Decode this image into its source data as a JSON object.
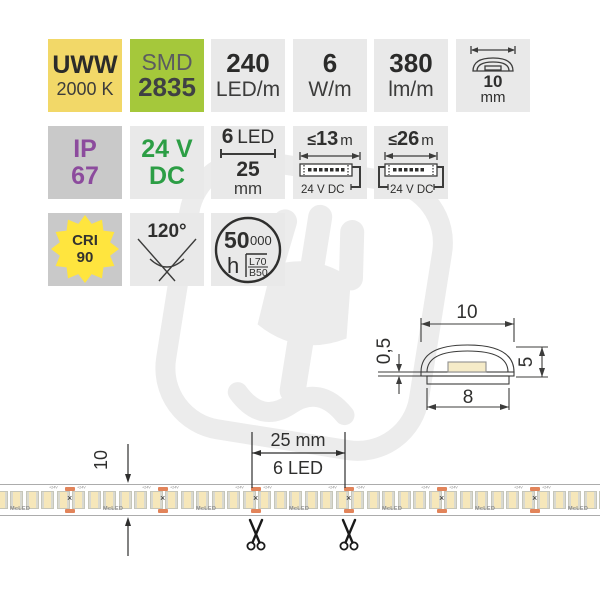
{
  "product_badges": {
    "color_temp": {
      "label": "UWW",
      "value": "2000 K"
    },
    "chip": {
      "label": "SMD",
      "value": "2835"
    },
    "density": {
      "value": "240",
      "unit": "LED/m"
    },
    "power": {
      "value": "6",
      "unit": "W/m"
    },
    "flux": {
      "value": "380",
      "unit": "lm/m"
    },
    "strip_width": {
      "value": "10",
      "unit": "mm"
    },
    "ip_rating": {
      "label": "IP",
      "value": "67"
    },
    "voltage": {
      "label": "24 V",
      "value": "DC"
    },
    "cut_step": {
      "count": "6",
      "count_word": "LED",
      "length": "25",
      "unit": "mm"
    },
    "max_run_single": {
      "prefix": "≤",
      "value": "13",
      "unit": "m",
      "feed": "24 V DC"
    },
    "max_run_double": {
      "prefix": "≤",
      "value": "26",
      "unit": "m",
      "feed": "24 V DC"
    },
    "cri": {
      "label": "CRI",
      "value": "90"
    },
    "beam_angle": {
      "value": "120°"
    },
    "lifetime": {
      "big": "50",
      "small": "000",
      "unit": "h",
      "l70": "L70",
      "b50": "B50"
    }
  },
  "cross_section": {
    "overall_width": "10",
    "pcb_thickness": "0,5",
    "height": "5",
    "pcb_width": "8"
  },
  "strip_annotations": {
    "width_label": "10",
    "pitch_label": "25 mm",
    "pitch_leds": "6 LED"
  },
  "strip": {
    "brand": "McLED",
    "plus_label": "+24V",
    "x_mark": "×",
    "segments": 7,
    "leds_per_segment": 6,
    "segment_px": 93,
    "first_cut_x": 70,
    "led_width": 11,
    "scissors_x": [
      256,
      349
    ]
  },
  "icons": {
    "profile_icon": "strip-profile-icon",
    "beam_angle_icon": "beam-angle-icon",
    "lifetime_icon": "lifetime-circle-icon",
    "cri_icon": "cri-starburst-icon",
    "run_icon": "max-run-strip-icon",
    "scissors": "scissors-icon",
    "watermark": "mcled-hand-watermark"
  },
  "colors": {
    "badge_yellow": "#F2D868",
    "badge_green": "#A5C83B",
    "badge_gray_light": "#E9E9E9",
    "badge_gray_dark": "#C9C9C9",
    "ip_purple": "#8C4B9D",
    "dc_green": "#2C9E45",
    "star_yellow": "#FFE53E",
    "pad_orange": "#E2845A",
    "led_cream": "#F6E7BA",
    "line_dark": "#3C3C3B",
    "watermark_gray": "#ECECEC"
  }
}
